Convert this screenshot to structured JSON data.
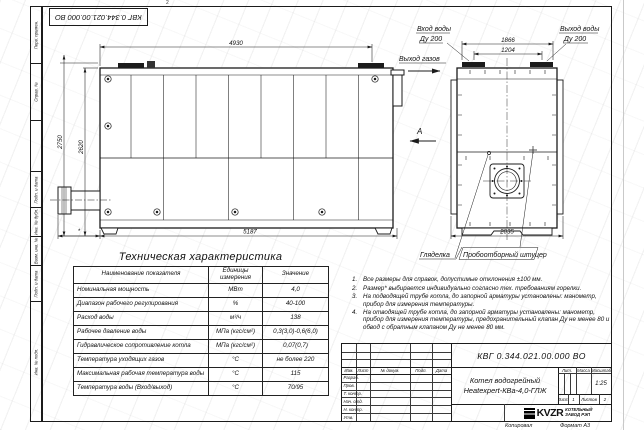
{
  "sheet": {
    "stamp_doc_number": "КВГ 0.344.021.00.000 ВО",
    "fold_mark_top": "2",
    "sidebar_labels": [
      "Перв. примен.",
      "Справ. №",
      "Подп. и дата",
      "Инв. № дубл.",
      "Взам. инв. №",
      "Подп. и дата",
      "Инв. № подл."
    ],
    "margin": {
      "copied": "Копировал",
      "format": "Формат А3"
    }
  },
  "drawing": {
    "main_view": {
      "dim_top": "4930",
      "dim_bottom": "5187",
      "dim_left_outer": "2750",
      "dim_left_inner": "2620",
      "dim_burner": "*",
      "gas_outlet": "Выход газов"
    },
    "end_view": {
      "dim_flanges_outer": "1866",
      "dim_flanges_inner": "1204",
      "dim_width": "2035",
      "inlet_line1": "Вход воды",
      "inlet_line2": "Ду 200",
      "outlet_line1": "Выход воды",
      "outlet_line2": "Ду 200",
      "view_label": "А",
      "sight_glass": "Гляделка",
      "sampling_port": "Пробоотборный штуцер"
    }
  },
  "tech_table": {
    "title": "Техническая характеристика",
    "headers": [
      "Наименование показателя",
      "Единицы измерения",
      "Значение"
    ],
    "rows": [
      [
        "Номинальная мощность",
        "МВт",
        "4,0"
      ],
      [
        "Диапазон рабочего регулирования",
        "%",
        "40-100"
      ],
      [
        "Расход воды",
        "м³/ч",
        "138"
      ],
      [
        "Рабочее давление воды",
        "МПа (кгс/см²)",
        "0,3(3,0)-0,6(6,0)"
      ],
      [
        "Гидравлическое сопротивление котла",
        "МПа (кгс/см²)",
        "0,07(0,7)"
      ],
      [
        "Температура уходящих газов",
        "°С",
        "не более 220"
      ],
      [
        "Максимальная рабочая температура воды",
        "°С",
        "115"
      ],
      [
        "Температура воды (Вход/выход)",
        "°С",
        "70/95"
      ]
    ]
  },
  "notes": [
    {
      "num": "1.",
      "text": "Все размеры для справок, допустимые отклонения ±100 мм."
    },
    {
      "num": "2.",
      "text": "Размер* выбирается индивидуально согласно тех. требованиям горелки."
    },
    {
      "num": "3.",
      "text": "На подводящей трубе котла, до запорной арматуры установлены: манометр, прибор для измерения температуры."
    },
    {
      "num": "4.",
      "text": "На отводящей трубе котла, до запорной арматуры установлены: манометр, прибор для измерения температуры, предохранительный клапан Ду не менее 80 и обвод с обратным клапаном Ду не менее 80 мм."
    }
  ],
  "title_block": {
    "doc_number": "КВГ 0.344.021.00.000 ВО",
    "rev_headers": [
      "Изм.",
      "Лист",
      "№ докум.",
      "Подп.",
      "Дата"
    ],
    "sign_rows": [
      "Разраб.",
      "Пров.",
      "Т. контр.",
      "Нач. отд.",
      "Н. контр.",
      "Утв."
    ],
    "product_line1": "Котел водогрейный",
    "product_line2": "Heatexpert-КВа-4,0-ГЛЖ",
    "lit": "Лит.",
    "mass": "Масса",
    "scale": "Масштаб",
    "scale_value": "1:25",
    "sheet": "Лист",
    "sheet_no": "1",
    "sheets": "Листов",
    "sheets_no": "2",
    "brand": "KVZR",
    "brand_line1": "КОТЕЛЬНЫЙ",
    "brand_line2": "ЗАВОД РЭП"
  }
}
